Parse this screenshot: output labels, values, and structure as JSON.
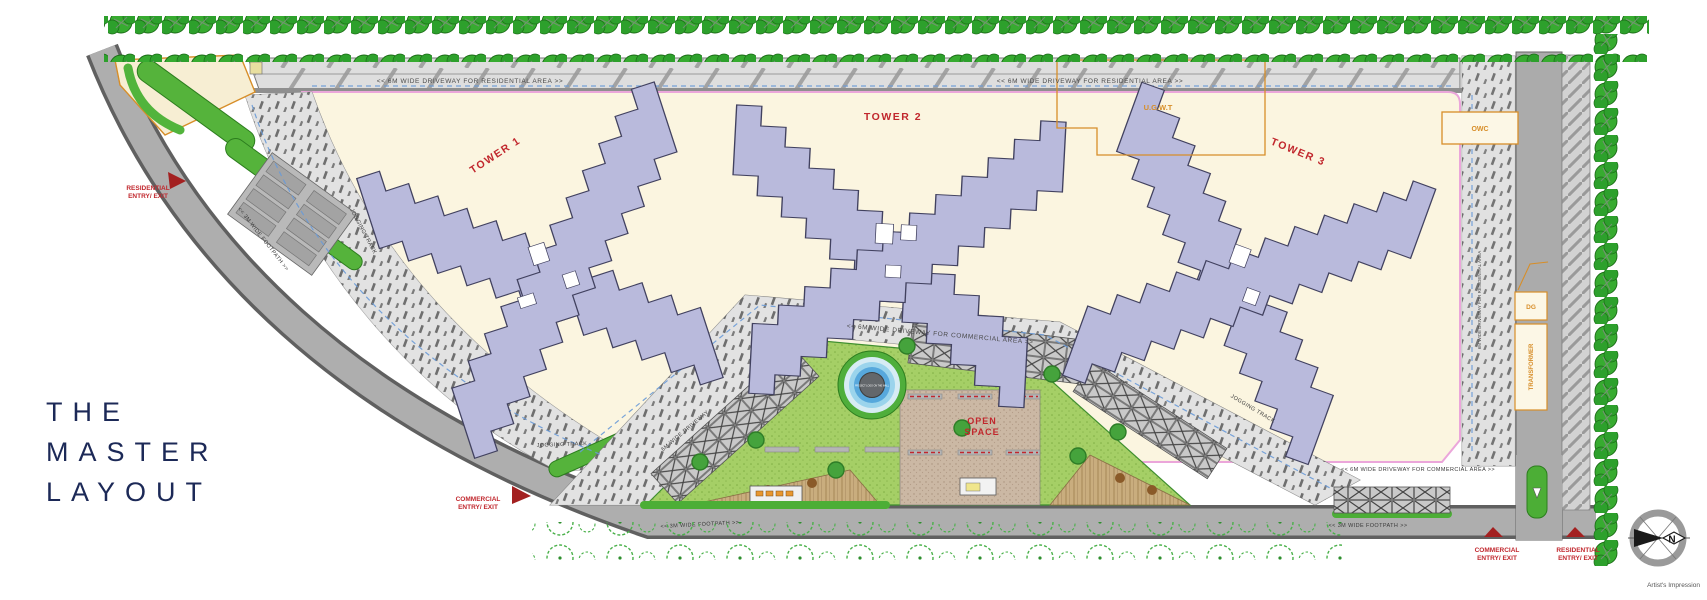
{
  "title": {
    "line1": "THE",
    "line2": "MASTER",
    "line3": "LAYOUT"
  },
  "towers": {
    "tower1": "TOWER 1",
    "tower2": "TOWER 2",
    "tower3": "TOWER 3"
  },
  "utilities": {
    "stp": "STP",
    "ugwt": "U.G.W.T",
    "owc": "OWC",
    "dg": "DG",
    "transformer": "TRANSFORMER"
  },
  "open_space": {
    "line1": "OPEN",
    "line2": "SPACE"
  },
  "entries": {
    "residential": {
      "line1": "RESIDENTIAL",
      "line2": "ENTRY/ EXIT"
    },
    "commercial": {
      "line1": "COMMERCIAL",
      "line2": "ENTRY/ EXIT"
    }
  },
  "roads": {
    "residential_driveway": "<<   6M WIDE DRIVEWAY FOR RESIDENTIAL AREA   >>",
    "commercial_driveway": "<<   6M WIDE DRIVEWAY FOR COMMERCIAL AREA   >>",
    "footpath": "<<   3M WIDE FOOTPATH   >>",
    "jogging_track": "JOGGING TRACK",
    "driveway_short": "6M WIDE DRIVEWAY",
    "right_driveway": "6M WIDE DRIVEWAY FOR RESIDENTIAL AREA"
  },
  "pool": {
    "note": "PROJECT LOGO ON THE WALL"
  },
  "compass": {
    "north": "N"
  },
  "footer": {
    "credit": "Artist's Impression"
  },
  "colors": {
    "title_navy": "#1c2957",
    "label_red": "#c1272d",
    "utility_orange": "#d78e29",
    "tower_fill": "#b9badc",
    "plot_cream": "#fbf5e0",
    "tree_green": "#2da02c",
    "lawn_green": "#a5cf66",
    "road_gray": "#ababab",
    "boundary_pink": "#eba6da",
    "track_blue": "#6a9bd8"
  }
}
